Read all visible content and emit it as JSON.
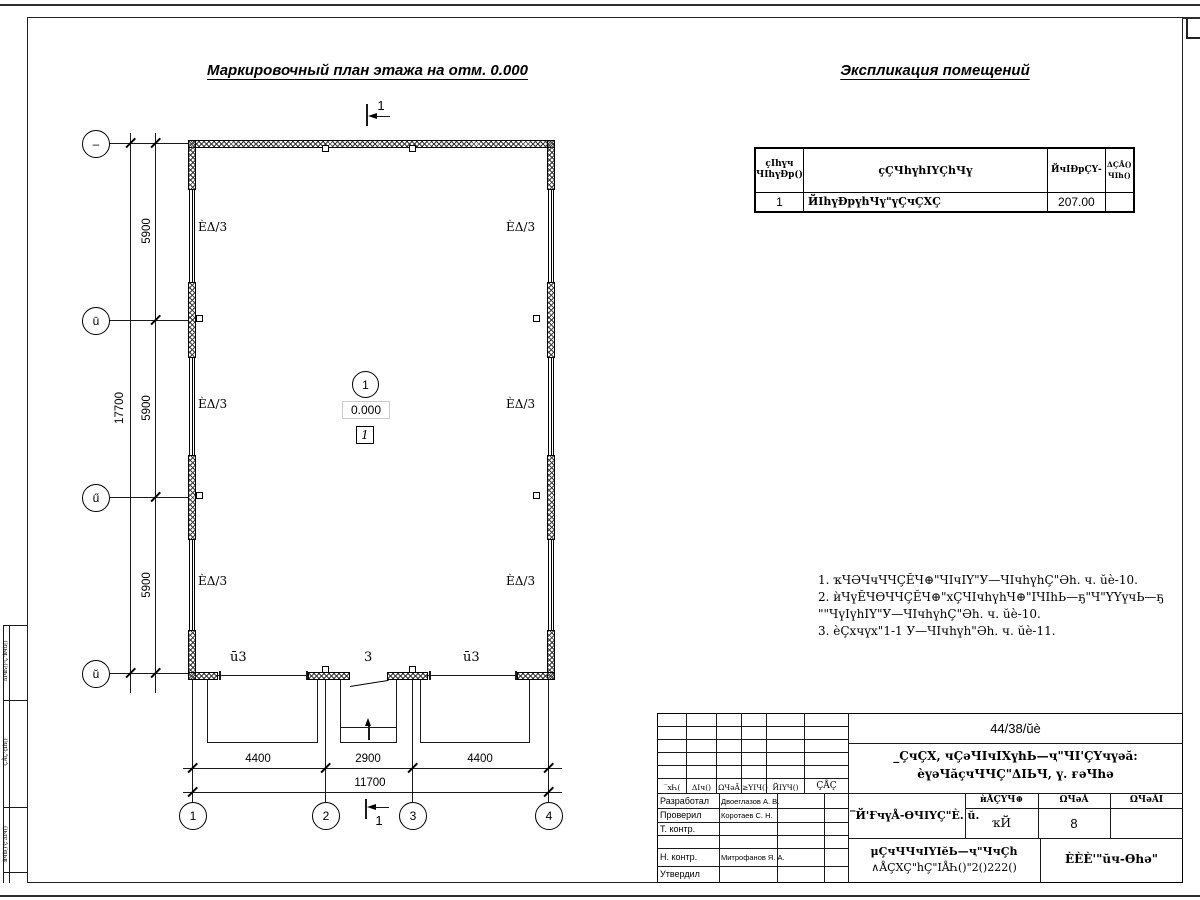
{
  "titles": {
    "plan": "Маркировочный план этажа на отм. 0.000",
    "explication": "Экспликация помещений"
  },
  "explication_table": {
    "headers": {
      "num_l1": "ҫIһүч",
      "num_l2": "ЧIһүÐр()",
      "name": "ҫҪЧһүһIҮҪһЧү",
      "area": "ЙчIÐрҪҮ-",
      "note_l1": "ΔҪÅ()",
      "note_l2": "ЧIһ()"
    },
    "rows": [
      {
        "num": "1",
        "name": "ЙIһүÐрүһЧү\"үҪчҪХҪ",
        "area": "207.00",
        "note": ""
      }
    ]
  },
  "notes": {
    "lines": [
      "1. ҡЧӘЧчЧЧҪĔЧ⊕\"ЧIчIY\"У—ЧIчһүһҪ\"Әһ. ч. ŭè-10.",
      "2. ѝЧүĔЧѲЧЧҪĔЧ⊕\"хҪЧIчһүһЧ⊕\"IЧIһЬ—ҕ\"Ч\"YҮүчЬ—ҕ",
      "\"\"ЧүIүһIY\"У—ЧIчһүһҪ\"Әһ. ч. ŭè-10.",
      "3. èҪхчүх\"1-1 У—ЧIчһүһ\"Әһ. ч. ŭè-11."
    ]
  },
  "plan": {
    "axes_bottom": [
      "1",
      "2",
      "3",
      "4"
    ],
    "axes_left": [
      "–",
      "ū",
      "ű",
      "ŭ"
    ],
    "dims": {
      "bottom": [
        "4400",
        "2900",
        "4400"
      ],
      "bottom_total": "11700",
      "left": [
        "5900",
        "5900",
        "5900"
      ],
      "left_total": "17700"
    },
    "labels": {
      "window": "ÈΔ/3",
      "door_side": "ū3",
      "door_center": "3",
      "room_number": "1",
      "elevation": "0.000",
      "room_box": "1",
      "section": "1"
    }
  },
  "title_block": {
    "doc_number": "44/38/ŭè",
    "object_l1": "_ҪчҪХ, чҪәЧIчIХүһЬ—ҷ\"ЧI'ҪҮчүәă:",
    "object_l2": "èүәЧăҫчЧЧҪ\"ΔIЬЧ, ү. ғәЧһә",
    "sheet_title": "‾Й'ҒчүÅ-ѲЧIҮҪ\"È. ŭ.",
    "doc_type_l1": "μҪчЧЧчIҮIĕЬ—ҷ\"ЧчҪһ",
    "doc_type_l2": "∧ÅҪХҪ\"һҪ\"IÅҺ()\"2()222()",
    "organization": "ÈÈÈ'\"ŭч-Ѳһә\"",
    "rev_headers": [
      "‾хҺ(",
      "ΔIч()",
      "ΩЧәĂ",
      "≥YIЧ()",
      "ЙIҮЧ()",
      "ҪÅҪ"
    ],
    "stage_headers": [
      "ѝÅҪҮЧ⊕",
      "ΩЧәĂ",
      "ΩЧәĂI"
    ],
    "stage": "ҡЙ",
    "sheet_no": "8",
    "sheets_total": "",
    "roles": [
      "Разработал",
      "Проверил",
      "Т. контр.",
      "Н. контр.",
      "Утвердил"
    ],
    "names": [
      "Двоеглазов А. В.",
      "Коротаев С. Н.",
      "Митрофанов Я. А."
    ]
  },
  "left_margin": {
    "cells": [
      "ΔIчҺ()·Ҫ·ѝчŭ()",
      "ҪÅҪ·ҫIһ()",
      "ѝчŭ()·ҫ·ΔIч()"
    ]
  }
}
